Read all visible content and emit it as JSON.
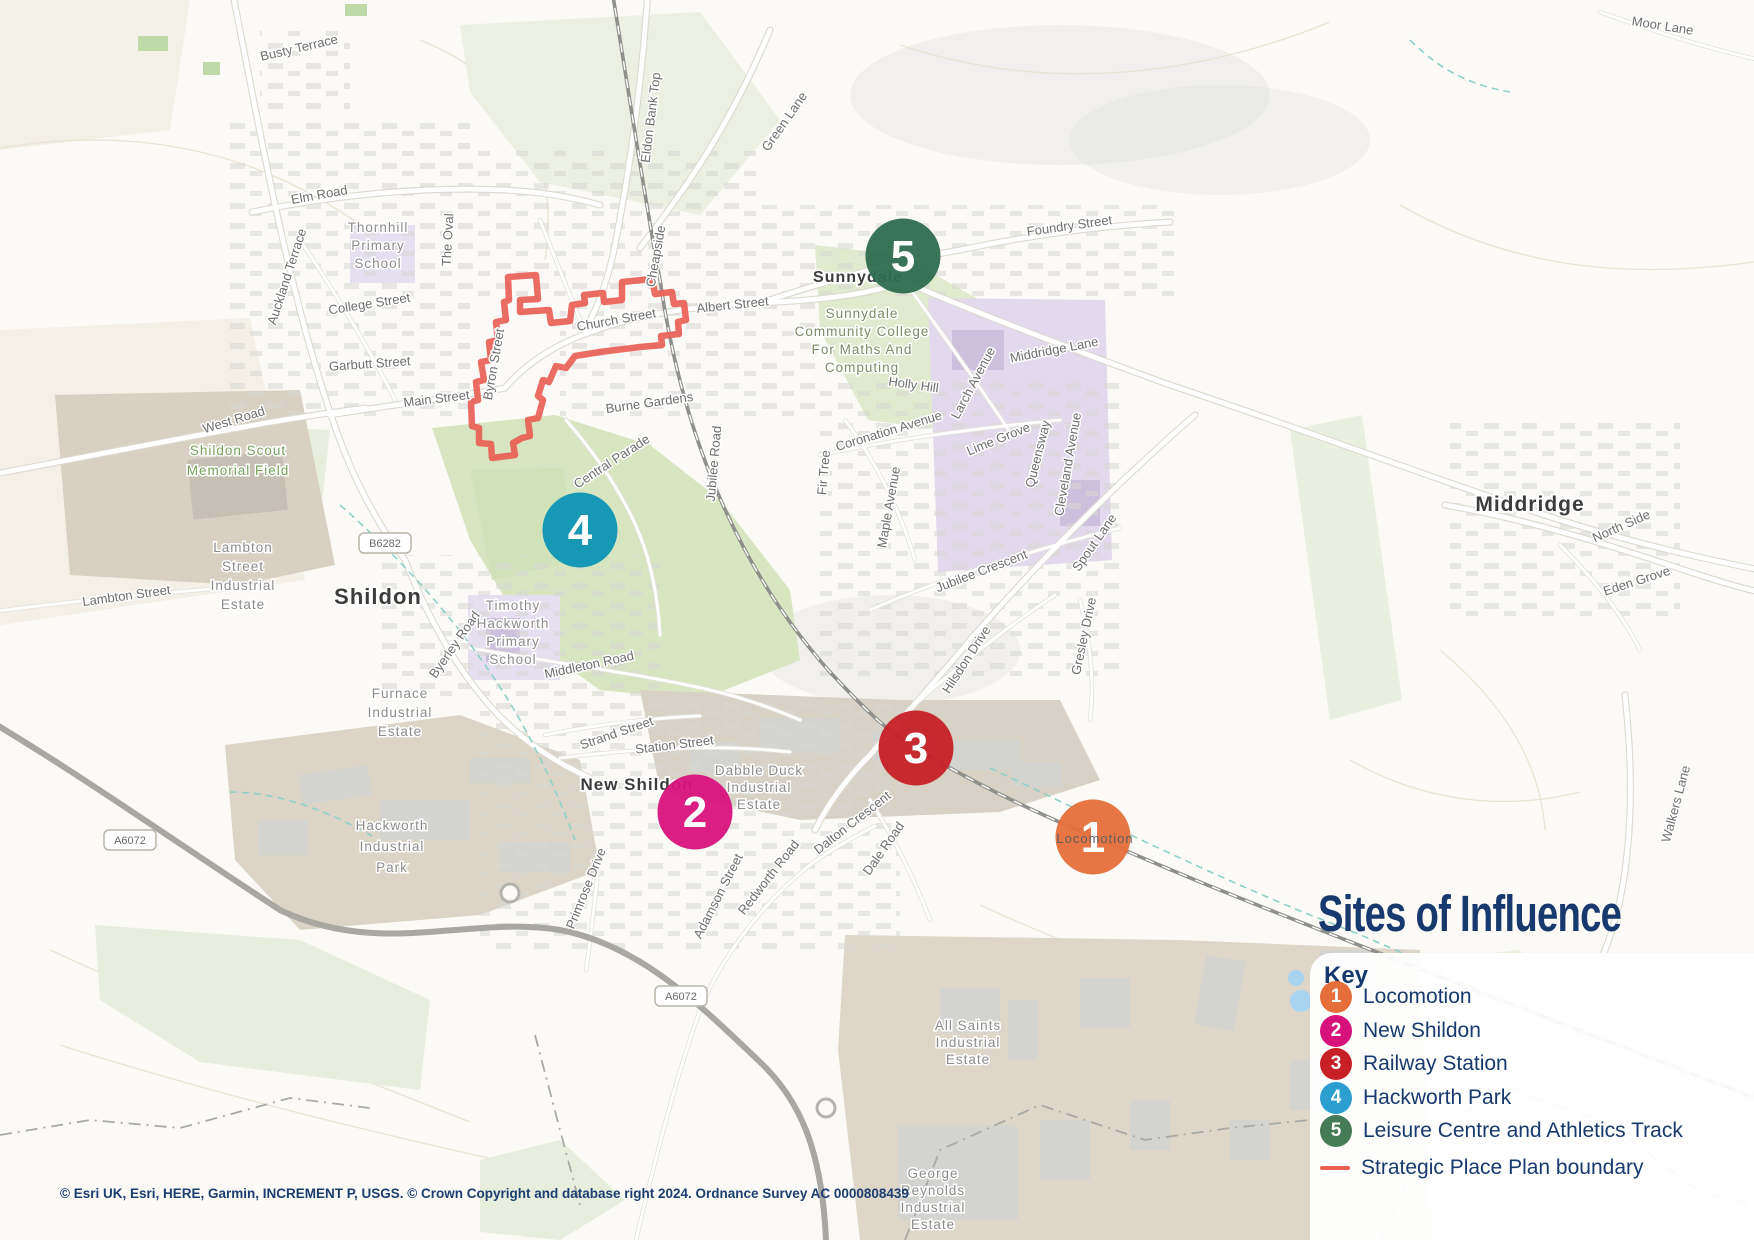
{
  "title": "Sites of Influence",
  "legend": {
    "key_label": "Key",
    "items": [
      {
        "num": "1",
        "color": "#E56F3A",
        "label": "Locomotion"
      },
      {
        "num": "2",
        "color": "#D8127D",
        "label": "New Shildon"
      },
      {
        "num": "3",
        "color": "#C52127",
        "label": "Railway Station"
      },
      {
        "num": "4",
        "color": "#2B9FD0",
        "label": "Hackworth Park"
      },
      {
        "num": "5",
        "color": "#457B57",
        "label": "Leisure Centre and Athletics Track"
      }
    ],
    "boundary": {
      "color": "#E95F55",
      "label": "Strategic Place Plan boundary"
    }
  },
  "attribution": "© Esri UK, Esri, HERE, Garmin, INCREMENT P, USGS. © Crown Copyright and database right 2024. Ordnance Survey AC 0000808439",
  "markers": [
    {
      "num": "1",
      "x": 1093,
      "y": 837,
      "color": "#E56F3A"
    },
    {
      "num": "2",
      "x": 695,
      "y": 812,
      "color": "#D8127D"
    },
    {
      "num": "3",
      "x": 916,
      "y": 748,
      "color": "#C52127"
    },
    {
      "num": "4",
      "x": 580,
      "y": 530,
      "color": "#0D93B4"
    },
    {
      "num": "5",
      "x": 903,
      "y": 256,
      "color": "#2E6B4F"
    }
  ],
  "map_labels": {
    "towns": [
      {
        "text": "Shildon",
        "x": 378,
        "y": 604,
        "size": 22
      },
      {
        "text": "New Shildon",
        "x": 637,
        "y": 790,
        "size": 17
      },
      {
        "text": "Middridge",
        "x": 1530,
        "y": 511,
        "size": 21
      },
      {
        "text": "Sunnydale",
        "x": 858,
        "y": 282,
        "size": 16
      }
    ],
    "streets": [
      {
        "text": "Busty Terrace",
        "x": 300,
        "y": 52,
        "r": -13
      },
      {
        "text": "Moor Lane",
        "x": 1662,
        "y": 30,
        "r": 9
      },
      {
        "text": "Eldon Bank Top",
        "x": 655,
        "y": 118,
        "r": -83
      },
      {
        "text": "Green Lane",
        "x": 788,
        "y": 124,
        "r": -55
      },
      {
        "text": "Foundry Street",
        "x": 1070,
        "y": 230,
        "r": -8
      },
      {
        "text": "Cheapside",
        "x": 660,
        "y": 257,
        "r": -80
      },
      {
        "text": "Albert Street",
        "x": 733,
        "y": 309,
        "r": -6
      },
      {
        "text": "Church Street",
        "x": 617,
        "y": 324,
        "r": -10
      },
      {
        "text": "Elm Road",
        "x": 320,
        "y": 199,
        "r": -10
      },
      {
        "text": "Auckland Terrace",
        "x": 291,
        "y": 278,
        "r": -72
      },
      {
        "text": "The Oval",
        "x": 452,
        "y": 240,
        "r": -87
      },
      {
        "text": "College Street",
        "x": 370,
        "y": 308,
        "r": -9
      },
      {
        "text": "Garbutt Street",
        "x": 370,
        "y": 368,
        "r": -4
      },
      {
        "text": "Byron Street",
        "x": 498,
        "y": 365,
        "r": -80
      },
      {
        "text": "Main Street",
        "x": 437,
        "y": 403,
        "r": -7
      },
      {
        "text": "West Road",
        "x": 235,
        "y": 424,
        "r": -17
      },
      {
        "text": "Burne Gardens",
        "x": 650,
        "y": 407,
        "r": -8
      },
      {
        "text": "Central Parade",
        "x": 614,
        "y": 465,
        "r": -33
      },
      {
        "text": "Holly Hill",
        "x": 913,
        "y": 389,
        "r": 8
      },
      {
        "text": "Larch Avenue",
        "x": 977,
        "y": 385,
        "r": -62
      },
      {
        "text": "Coronation Avenue",
        "x": 890,
        "y": 435,
        "r": -17
      },
      {
        "text": "Lime Grove",
        "x": 1000,
        "y": 443,
        "r": -22
      },
      {
        "text": "Queensway",
        "x": 1042,
        "y": 455,
        "r": -76
      },
      {
        "text": "Cleveland Avenue",
        "x": 1072,
        "y": 465,
        "r": -80
      },
      {
        "text": "Middridge Lane",
        "x": 1055,
        "y": 354,
        "r": -11
      },
      {
        "text": "Fir Tree",
        "x": 828,
        "y": 473,
        "r": -85
      },
      {
        "text": "Maple Avenue",
        "x": 893,
        "y": 508,
        "r": -80
      },
      {
        "text": "Jubilee Road",
        "x": 718,
        "y": 464,
        "r": -85
      },
      {
        "text": "Jubilee Crescent",
        "x": 983,
        "y": 575,
        "r": -21
      },
      {
        "text": "Spout Lane",
        "x": 1098,
        "y": 545,
        "r": -55
      },
      {
        "text": "Gresley Drive",
        "x": 1088,
        "y": 637,
        "r": -78
      },
      {
        "text": "Hilsdon Drive",
        "x": 970,
        "y": 662,
        "r": -57
      },
      {
        "text": "North Side",
        "x": 1623,
        "y": 530,
        "r": -24
      },
      {
        "text": "Eden Grove",
        "x": 1638,
        "y": 585,
        "r": -18
      },
      {
        "text": "Walkers Lane",
        "x": 1680,
        "y": 805,
        "r": -75
      },
      {
        "text": "Byerley Road",
        "x": 458,
        "y": 647,
        "r": -55
      },
      {
        "text": "Middleton Road",
        "x": 590,
        "y": 669,
        "r": -12
      },
      {
        "text": "Strand Street",
        "x": 618,
        "y": 737,
        "r": -19
      },
      {
        "text": "Station Street",
        "x": 675,
        "y": 749,
        "r": -7
      },
      {
        "text": "Dalton Crescent",
        "x": 855,
        "y": 826,
        "r": -38
      },
      {
        "text": "Dale Road",
        "x": 887,
        "y": 851,
        "r": -55
      },
      {
        "text": "Redworth Road",
        "x": 772,
        "y": 880,
        "r": -52
      },
      {
        "text": "Primrose Drive",
        "x": 590,
        "y": 890,
        "r": -68
      },
      {
        "text": "Adamson Street",
        "x": 722,
        "y": 898,
        "r": -63
      },
      {
        "text": "Lambton Street",
        "x": 127,
        "y": 600,
        "r": -8
      }
    ],
    "areas": [
      {
        "lines": [
          "Thornhill",
          "Primary",
          "School"
        ],
        "x": 378,
        "y": 232,
        "lh": 18,
        "color": "#8c8c8c"
      },
      {
        "lines": [
          "Sunnydale",
          "Community College",
          "For Maths And",
          "Computing"
        ],
        "x": 862,
        "y": 318,
        "lh": 18,
        "color": "#7c8c66"
      },
      {
        "lines": [
          "Shildon Scout",
          "Memorial Field"
        ],
        "x": 238,
        "y": 455,
        "lh": 20,
        "color": "#76a05b"
      },
      {
        "lines": [
          "Lambton",
          "Street",
          "Industrial",
          "Estate"
        ],
        "x": 243,
        "y": 552,
        "lh": 19,
        "color": "#8c8c8c"
      },
      {
        "lines": [
          "Timothy",
          "Hackworth",
          "Primary",
          "School"
        ],
        "x": 513,
        "y": 610,
        "lh": 18,
        "color": "#8c8c8c"
      },
      {
        "lines": [
          "Furnace",
          "Industrial",
          "Estate"
        ],
        "x": 400,
        "y": 698,
        "lh": 19,
        "color": "#8c8c8c"
      },
      {
        "lines": [
          "Hackworth",
          "Industrial",
          "Park"
        ],
        "x": 392,
        "y": 830,
        "lh": 21,
        "color": "#8c8c8c"
      },
      {
        "lines": [
          "Dabble Duck",
          "Industrial",
          "Estate"
        ],
        "x": 759,
        "y": 775,
        "lh": 17,
        "color": "#8c8c8c"
      },
      {
        "lines": [
          "All Saints",
          "Industrial",
          "Estate"
        ],
        "x": 968,
        "y": 1030,
        "lh": 17,
        "color": "#8c8c8c"
      },
      {
        "lines": [
          "George",
          "Reynolds",
          "Industrial",
          "Estate"
        ],
        "x": 933,
        "y": 1178,
        "lh": 17,
        "color": "#8c8c8c"
      }
    ],
    "shields": [
      {
        "text": "B6282",
        "x": 385,
        "y": 543
      },
      {
        "text": "A6072",
        "x": 130,
        "y": 840
      },
      {
        "text": "A6072",
        "x": 681,
        "y": 996
      }
    ],
    "over_marker": {
      "text": "Locomotion",
      "x": 1095,
      "y": 843
    }
  }
}
